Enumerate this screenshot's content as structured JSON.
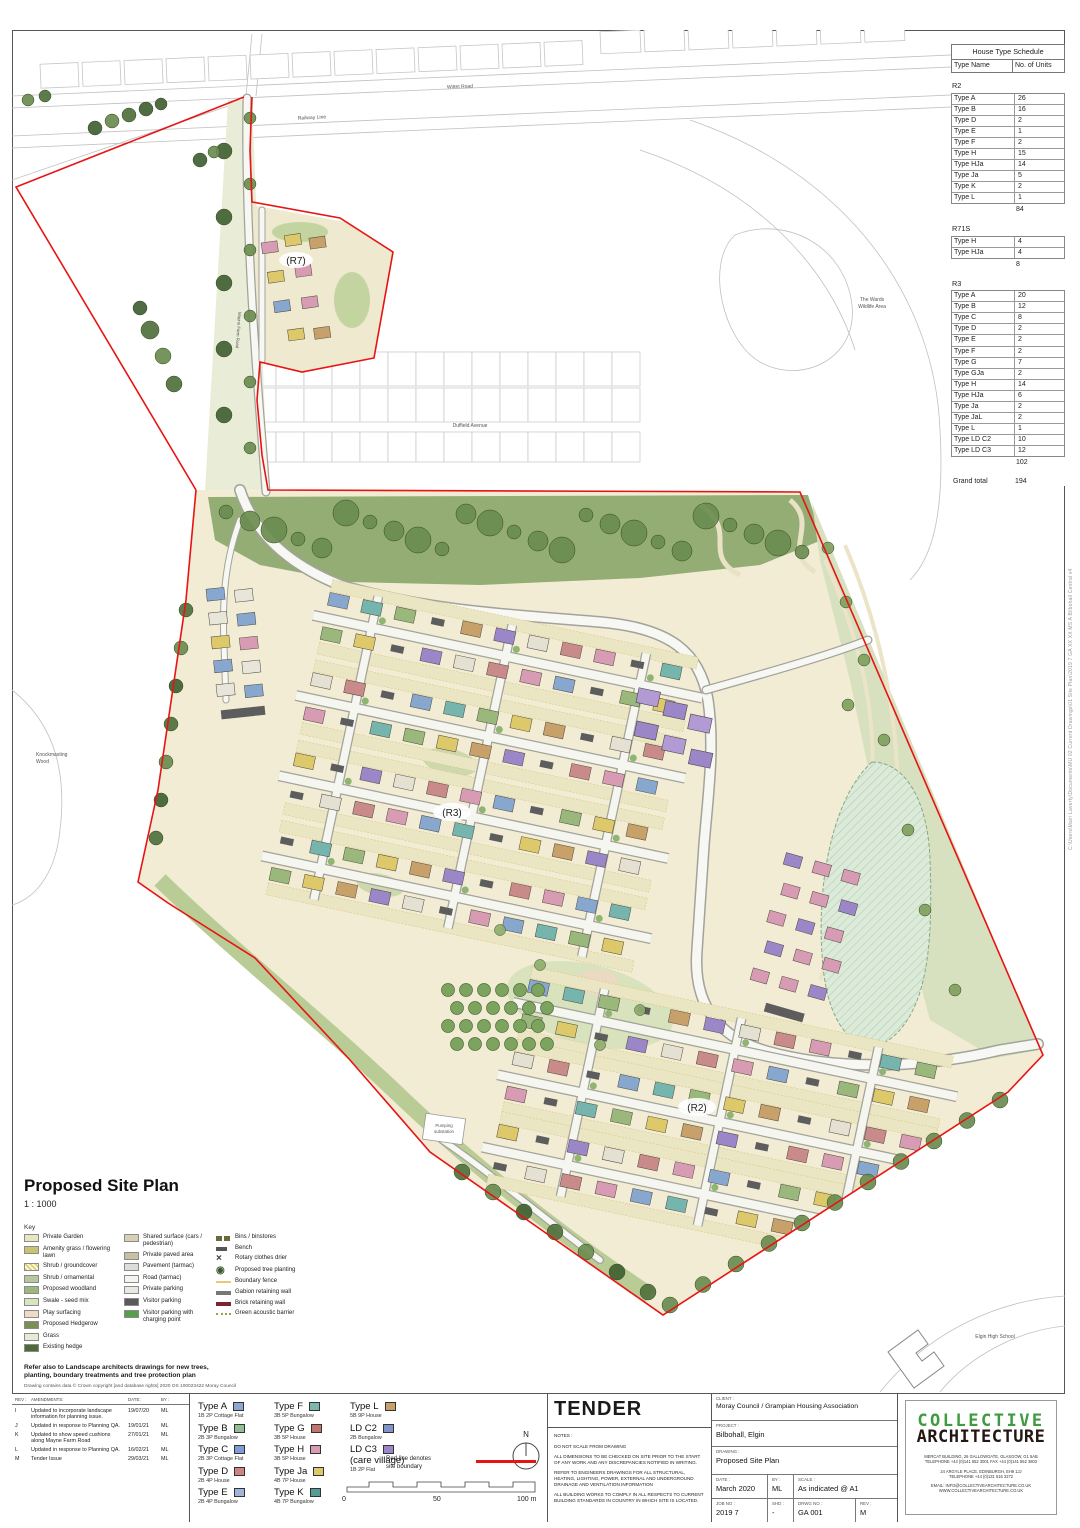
{
  "plan": {
    "labels": {
      "r7": "(R7)",
      "r3": "(R3)",
      "r2": "(R2)",
      "railway": "Railway Line",
      "wittet_road": "Wittet Road",
      "duffield_avenue": "Duffield Avenue",
      "mayne_farm_road": "Mayne Farm Road",
      "wards_1": "The Wards",
      "wards_2": "Wildlife Area",
      "knockmasting_1": "Knockmasting",
      "knockmasting_2": "Wood",
      "elgin_high": "Elgin High School",
      "pumping_1": "Pumping",
      "pumping_2": "substation"
    }
  },
  "schedule": {
    "title": "House Type Schedule",
    "columns": [
      "Type Name",
      "No. of Units"
    ],
    "groups": [
      {
        "name": "R2",
        "rows": [
          [
            "Type A",
            "26"
          ],
          [
            "Type B",
            "16"
          ],
          [
            "Type D",
            "2"
          ],
          [
            "Type E",
            "1"
          ],
          [
            "Type F",
            "2"
          ],
          [
            "Type H",
            "15"
          ],
          [
            "Type HJa",
            "14"
          ],
          [
            "Type Ja",
            "5"
          ],
          [
            "Type K",
            "2"
          ],
          [
            "Type L",
            "1"
          ]
        ],
        "total": "84"
      },
      {
        "name": "R71S",
        "rows": [
          [
            "Type H",
            "4"
          ],
          [
            "Type HJa",
            "4"
          ]
        ],
        "total": "8"
      },
      {
        "name": "R3",
        "rows": [
          [
            "Type A",
            "20"
          ],
          [
            "Type B",
            "12"
          ],
          [
            "Type C",
            "8"
          ],
          [
            "Type D",
            "2"
          ],
          [
            "Type E",
            "2"
          ],
          [
            "Type F",
            "2"
          ],
          [
            "Type G",
            "7"
          ],
          [
            "Type GJa",
            "2"
          ],
          [
            "Type H",
            "14"
          ],
          [
            "Type HJa",
            "6"
          ],
          [
            "Type Ja",
            "2"
          ],
          [
            "Type JaL",
            "2"
          ],
          [
            "Type L",
            "1"
          ],
          [
            "Type LD C2",
            "10"
          ],
          [
            "Type LD C3",
            "12"
          ]
        ],
        "total": "102"
      }
    ],
    "grand_label": "Grand total",
    "grand_total": "194"
  },
  "titlearea": {
    "title": "Proposed Site Plan",
    "scale": "1 : 1000"
  },
  "key": {
    "heading": "Key",
    "columns": [
      [
        {
          "label": "Private Garden",
          "t": "rect",
          "c": "#e9e6bf",
          "icon": "private-garden-swatch"
        },
        {
          "label": "Amenity grass / flowering lawn",
          "t": "rect",
          "c": "#c8c272",
          "icon": "amenity-grass-swatch"
        },
        {
          "label": "Shrub / groundcover",
          "t": "hatch",
          "c": "#ded470",
          "icon": "shrub-groundcover-swatch"
        },
        {
          "label": "Shrub / ornamental",
          "t": "rect",
          "c": "#b7c8a0",
          "icon": "shrub-ornamental-swatch"
        },
        {
          "label": "Proposed woodland",
          "t": "rect",
          "c": "#9cb87c",
          "icon": "proposed-woodland-swatch"
        },
        {
          "label": "Swale - seed mix",
          "t": "rect",
          "c": "#d9e4c4",
          "icon": "swale-swatch"
        },
        {
          "label": "Play surfacing",
          "t": "rect",
          "c": "#eedbc4",
          "icon": "play-surfacing-swatch"
        },
        {
          "label": "Proposed Hedgerow",
          "t": "rect",
          "c": "#7a8f52",
          "icon": "proposed-hedgerow-swatch"
        },
        {
          "label": "Grass",
          "t": "rect",
          "c": "#e6ebd4",
          "icon": "grass-swatch"
        },
        {
          "label": "Existing hedge",
          "t": "rect",
          "c": "#4e6a39",
          "icon": "existing-hedge-swatch"
        }
      ],
      [
        {
          "label": "Shared surface (cars / pedestrian)",
          "t": "rect",
          "c": "#d8d0b2",
          "icon": "shared-surface-swatch"
        },
        {
          "label": "Private paved area",
          "t": "rect",
          "c": "#c8c0a3",
          "icon": "private-paved-swatch"
        },
        {
          "label": "Pavement (tarmac)",
          "t": "rect",
          "c": "#dddddb",
          "icon": "pavement-swatch"
        },
        {
          "label": "Road (tarmac)",
          "t": "rect",
          "c": "#f4f4f1",
          "icon": "road-swatch"
        },
        {
          "label": "Private parking",
          "t": "rect",
          "c": "#e9e8e3",
          "icon": "private-parking-swatch"
        },
        {
          "label": "Visitor parking",
          "t": "rect",
          "c": "#5a5a5a",
          "icon": "visitor-parking-swatch"
        },
        {
          "label": "Visitor parking with charging point",
          "t": "rect",
          "c": "#56a04c",
          "icon": "visitor-parking-charging-swatch"
        }
      ],
      [
        {
          "label": "Bins / binstores",
          "t": "bins",
          "c": "#6a6a3a",
          "icon": "bins-symbol"
        },
        {
          "label": "Bench",
          "t": "bench",
          "c": "#555555",
          "icon": "bench-symbol"
        },
        {
          "label": "Rotary clothes drier",
          "t": "rotary",
          "c": "#444444",
          "icon": "rotary-drier-symbol"
        },
        {
          "label": "Proposed tree planting",
          "t": "tree",
          "c": "#3a5a30",
          "icon": "tree-planting-symbol"
        },
        {
          "label": "Boundary fence",
          "t": "line",
          "c": "#e9c87c",
          "icon": "boundary-fence-symbol"
        },
        {
          "label": "Gabion retaining wall",
          "t": "linethick",
          "c": "#777777",
          "icon": "gabion-wall-symbol"
        },
        {
          "label": "Brick retaining wall",
          "t": "linethick",
          "c": "#7c2430",
          "icon": "brick-wall-symbol"
        },
        {
          "label": "Green acoustic barrier",
          "t": "dotted",
          "c": "#9aa24a",
          "icon": "acoustic-barrier-symbol"
        }
      ]
    ],
    "note1": "Refer also to Landscape architects drawings for new trees,",
    "note2": "planting, boundary treatments and tree protection plan",
    "copyright": "Drawing contains data © Crown copyright [and database rights] 2020 OS 100023422 Moray Council"
  },
  "revisions": {
    "headers": [
      "REV :",
      "AMENDMENTS:",
      "DATE:",
      "BY :"
    ],
    "rows": [
      {
        "rev": "I",
        "text": "Updated to incorporate landscape information for planning issue.",
        "date": "19/07/20",
        "by": "ML"
      },
      {
        "rev": "J",
        "text": "Updated in response to Planning QA.",
        "date": "19/01/21",
        "by": "ML"
      },
      {
        "rev": "K",
        "text": "Updated to show speed cushions along Mayne Farm Road",
        "date": "27/01/21",
        "by": "ML"
      },
      {
        "rev": "L",
        "text": "Updated in response to Planning QA.",
        "date": "16/02/21",
        "by": "ML"
      },
      {
        "rev": "M",
        "text": "Tender Issue",
        "date": "29/03/21",
        "by": "ML"
      }
    ]
  },
  "house_legend": {
    "columns": [
      [
        {
          "name": "Type A",
          "desc": "1B 2P Cottage Flat",
          "color": "#8aa8d2"
        },
        {
          "name": "Type B",
          "desc": "2B 3P Bungalow",
          "color": "#8fbf92"
        },
        {
          "name": "Type C",
          "desc": "2B 3P Cottage Flat",
          "color": "#7f9cd4"
        },
        {
          "name": "Type D",
          "desc": "2B 4P House",
          "color": "#cc8484"
        },
        {
          "name": "Type E",
          "desc": "2B 4P Bungalow",
          "color": "#9fb6da"
        }
      ],
      [
        {
          "name": "Type F",
          "desc": "3B 5P Bungalow",
          "color": "#79b8ae"
        },
        {
          "name": "Type G",
          "desc": "3B 5P House",
          "color": "#c2736c"
        },
        {
          "name": "Type H",
          "desc": "3B 5P House",
          "color": "#d79cb4"
        },
        {
          "name": "Type Ja",
          "desc": "4B 7P House",
          "color": "#ddc96a"
        },
        {
          "name": "Type K",
          "desc": "4B 7P Bungalow",
          "color": "#569c94"
        }
      ],
      [
        {
          "name": "Type L",
          "desc": "5B 9P House",
          "color": "#c8a06a"
        },
        {
          "name": "LD C2",
          "desc": "2B Bungalow",
          "color": "#8194c9"
        },
        {
          "name": "LD C3",
          "sub": "(care village)",
          "desc": "1B 2P Flat",
          "color": "#9b86c8"
        }
      ]
    ]
  },
  "compass": {
    "n": "N"
  },
  "boundary_note": {
    "line1": "Red line denotes",
    "line2": "site boundary"
  },
  "scalebar": {
    "zero": "0",
    "fifty": "50",
    "hundred": "100 m"
  },
  "tender": {
    "title": "TENDER",
    "notes_label": "NOTES :",
    "notes": [
      "DO NOT SCALE FROM DRAWING",
      "ALL DIMENSIONS TO BE CHECKED ON SITE PRIOR TO THE START OF ANY WORK AND ANY DISCREPANCIES NOTIFIED IN WRITING.",
      "REFER TO ENGINEERS DRAWINGS FOR ALL STRUCTURAL, HEATING, LIGHTING, POWER, EXTERNAL AND UNDERGROUND DRAINAGE AND VENTILATION INFORMATION",
      "ALL BUILDING WORKS TO COMPLY IN ALL RESPECTS TO CURRENT BUILDING STANDARDS IN COUNTRY IN WHICH SITE IS LOCATED."
    ]
  },
  "titleblock": {
    "client_label": "CLIENT :",
    "client": "Moray Council / Grampian Housing Association",
    "project_label": "PROJECT :",
    "project": "Bilbohall, Elgin",
    "drawing_label": "DRAWING :",
    "drawing": "Proposed Site Plan",
    "date_label": "DATE :",
    "date": "March 2020",
    "by_label": "BY :",
    "by": "ML",
    "scale_label": "SCALE :",
    "scale": "As indicated @ A1",
    "job_label": "JOB NO :",
    "job": "2019 7",
    "shd_label": "SHD :",
    "shd": "-",
    "dwg_label": "DRWG NO :",
    "dwg": "GA 001",
    "rev_label": "REV :",
    "rev": "M"
  },
  "logo": {
    "line1": "COLLECTIVE",
    "line2": "ARCHITECTURE",
    "address_groups": [
      [
        "MERCAT BUILDING, 26 GALLOWGATE, GLASGOW, G1 5AB",
        "TELEPHONE +44 (0)141 552 3001 FAX +44 (0)141 552 3803"
      ],
      [
        "24 ARGYLE PLACE, EDINBURGH, EH9 1JJ",
        "TELEPHONE +44 (0)131 516 3272"
      ],
      [
        "EMAIL: INFO@COLLECTIVEARCHITECTURE.CO.UK",
        "WWW.COLLECTIVEARCHITECTURE.CO.UK"
      ]
    ]
  },
  "edge_note": "C:\\Users\\Mairi Laverty\\Documents\\MU 02 Current Drawings\\01 Site Plan\\2019 7 GA XX XX MS A Bilbohall Central v4"
}
